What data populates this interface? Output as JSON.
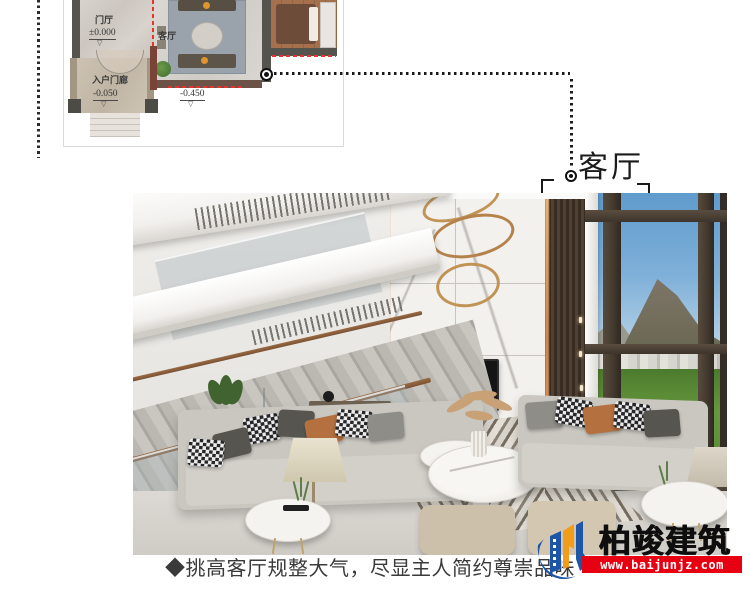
{
  "floor_plan": {
    "foyer_label": "门厅",
    "foyer_elevation": "±0.000",
    "living_label": "客厅",
    "porch_label": "入户门廊",
    "porch_elevation": "-0.050",
    "living_elevation": "-0.450",
    "level_mark_glyph": "▽",
    "highlight_color": "#e8322d"
  },
  "callout": {
    "label": "客厅"
  },
  "caption": {
    "text": "◆挑高客厅规整大气，尽显主人简约尊崇品味"
  },
  "logo": {
    "name": "柏竣建筑",
    "url": "www.baijunjz.com",
    "colors": {
      "blue": "#1d55a7",
      "yellow": "#f29c1c",
      "red": "#e60012"
    }
  }
}
